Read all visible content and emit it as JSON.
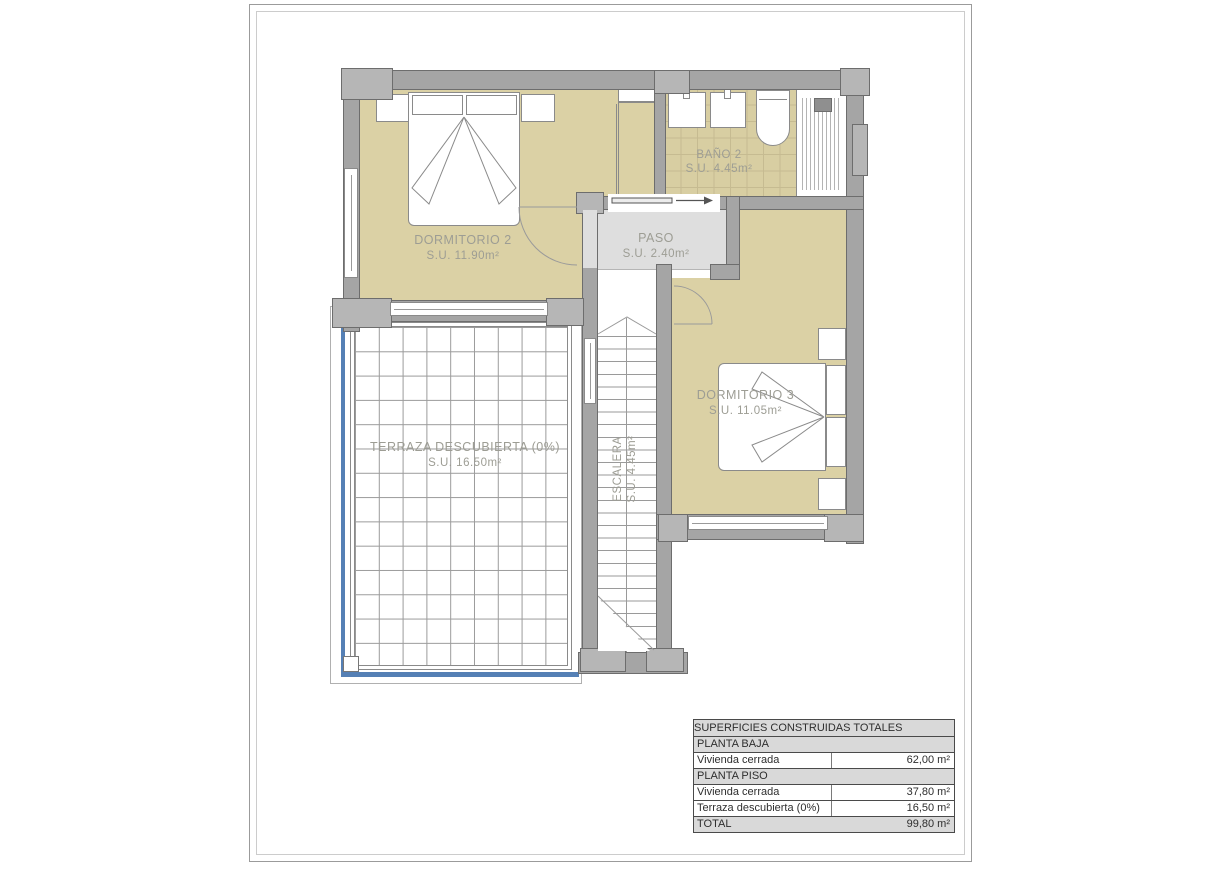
{
  "plan": {
    "rooms": {
      "dormitorio2": {
        "name": "DORMITORIO 2",
        "area": "S.U. 11.90m²"
      },
      "bano2": {
        "name": "BAÑO 2",
        "area": "S.U. 4.45m²"
      },
      "paso": {
        "name": "PASO",
        "area": "S.U. 2.40m²"
      },
      "dormitorio3": {
        "name": "DORMITORIO 3",
        "area": "S.U. 11.05m²"
      },
      "terraza": {
        "name": "TERRAZA DESCUBIERTA (0%)",
        "area": "S.U. 16.50m²"
      },
      "escalera": {
        "name": "ESCALERA",
        "area": "S.U. 4.45m²"
      }
    }
  },
  "summary_table": {
    "title": "SUPERFICIES CONSTRUIDAS TOTALES",
    "rows": [
      {
        "label": "PLANTA BAJA",
        "value": ""
      },
      {
        "label": "Vivienda cerrada",
        "value": "62,00 m²"
      },
      {
        "label": "PLANTA PISO",
        "value": ""
      },
      {
        "label": "Vivienda cerrada",
        "value": "37,80 m²"
      },
      {
        "label": "Terraza descubierta (0%)",
        "value": "16,50 m²"
      },
      {
        "label": "TOTAL",
        "value": "99,80 m²"
      }
    ]
  },
  "colors": {
    "floor_beige": "#dbd1a5",
    "wall_gray": "#a5a5a5",
    "hall_gray": "#dedede",
    "terrace_blue": "#5580b5"
  }
}
